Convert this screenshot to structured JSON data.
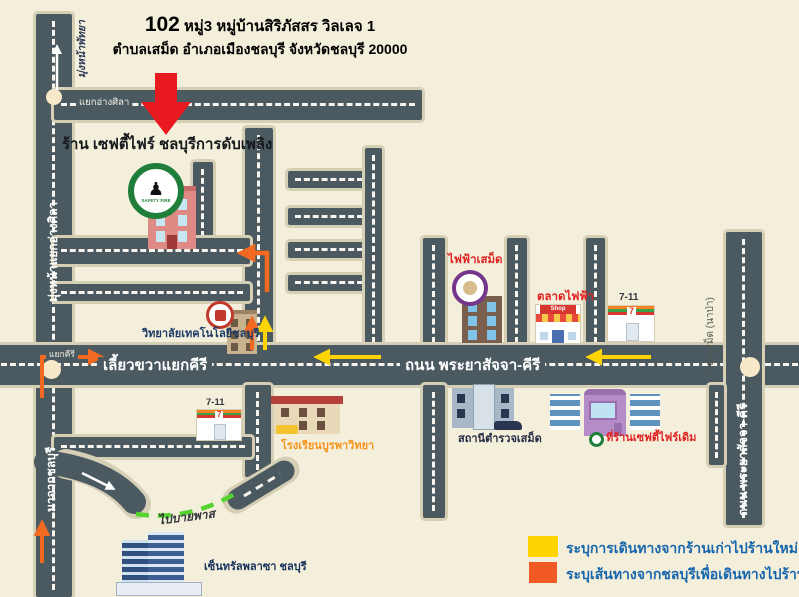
{
  "title": {
    "number": "102",
    "line1_rest": "หมู่3 หมู่บ้านสิริภัสสร วิลเลจ 1",
    "line2": "ตำบลเสม็ด อำเภอเมืองชลบุรี จังหวัดชลบุรี 20000"
  },
  "shop": {
    "label": "ร้าน เซฟตี้ไฟร์ ชลบุรีการดับเพลิง",
    "logo_ring_text": "SAFETY FIRE"
  },
  "roads": {
    "heading_angsila": "มุ่งหน้าแยกอ่างศิลา",
    "heading_pattaya": "มุ่งหน้าพัทยา",
    "junction_angsila": "แยกอ่างศิลา",
    "junction_kiri_small": "แยกคีรี",
    "turn_right_kiri": "เลี้ยวขวาแยกคีรี",
    "main_road_name": "ถนน พระยาสัจจา-คีรี",
    "right_road_name": "ถนน พระยาสัจจา-คีรี",
    "right_road_note": "แยกเสม็ด (นาป่า)",
    "from_chonburi": "มาจากชลบุรี",
    "to_bypass": "ไปบายพาส"
  },
  "places": {
    "power_office": "ไฟฟ้าเสม็ด",
    "market": "ตลาดไฟฟ้า",
    "market_sign": "Shop",
    "seven_eleven_top": "7-11",
    "seven_glyph": "7",
    "college": "วิทยาลัยเทคโนโลยีชลบุรี",
    "seven_eleven_bottom": "7-11",
    "school": "โรงเรียนบูรพาวิทยา",
    "police_station": "สถานีตำรวจเสม็ด",
    "old_shop": "ที่ร้านเซฟตี้ไฟร์เดิม",
    "central_plaza": "เซ็นทรัลพลาซา ชลบุรี"
  },
  "legend": {
    "items": [
      {
        "color": "#ffd400",
        "label": "ระบุการเดินทางจากร้านเก่าไปร้านใหม่"
      },
      {
        "color": "#f15a24",
        "label": "ระบุเส้นทางจากชลบุรีเพื่อเดินทางไปร้านใหม่"
      }
    ]
  },
  "colors": {
    "background": "#f4efdb",
    "road": "#4b5a61",
    "road_border": "#d5cfb6",
    "route_yellow": "#ffd400",
    "route_orange": "#f26a21",
    "bypass_green": "#55d32e",
    "marker_red": "#e8191f",
    "legend_text": "#1766ad"
  }
}
